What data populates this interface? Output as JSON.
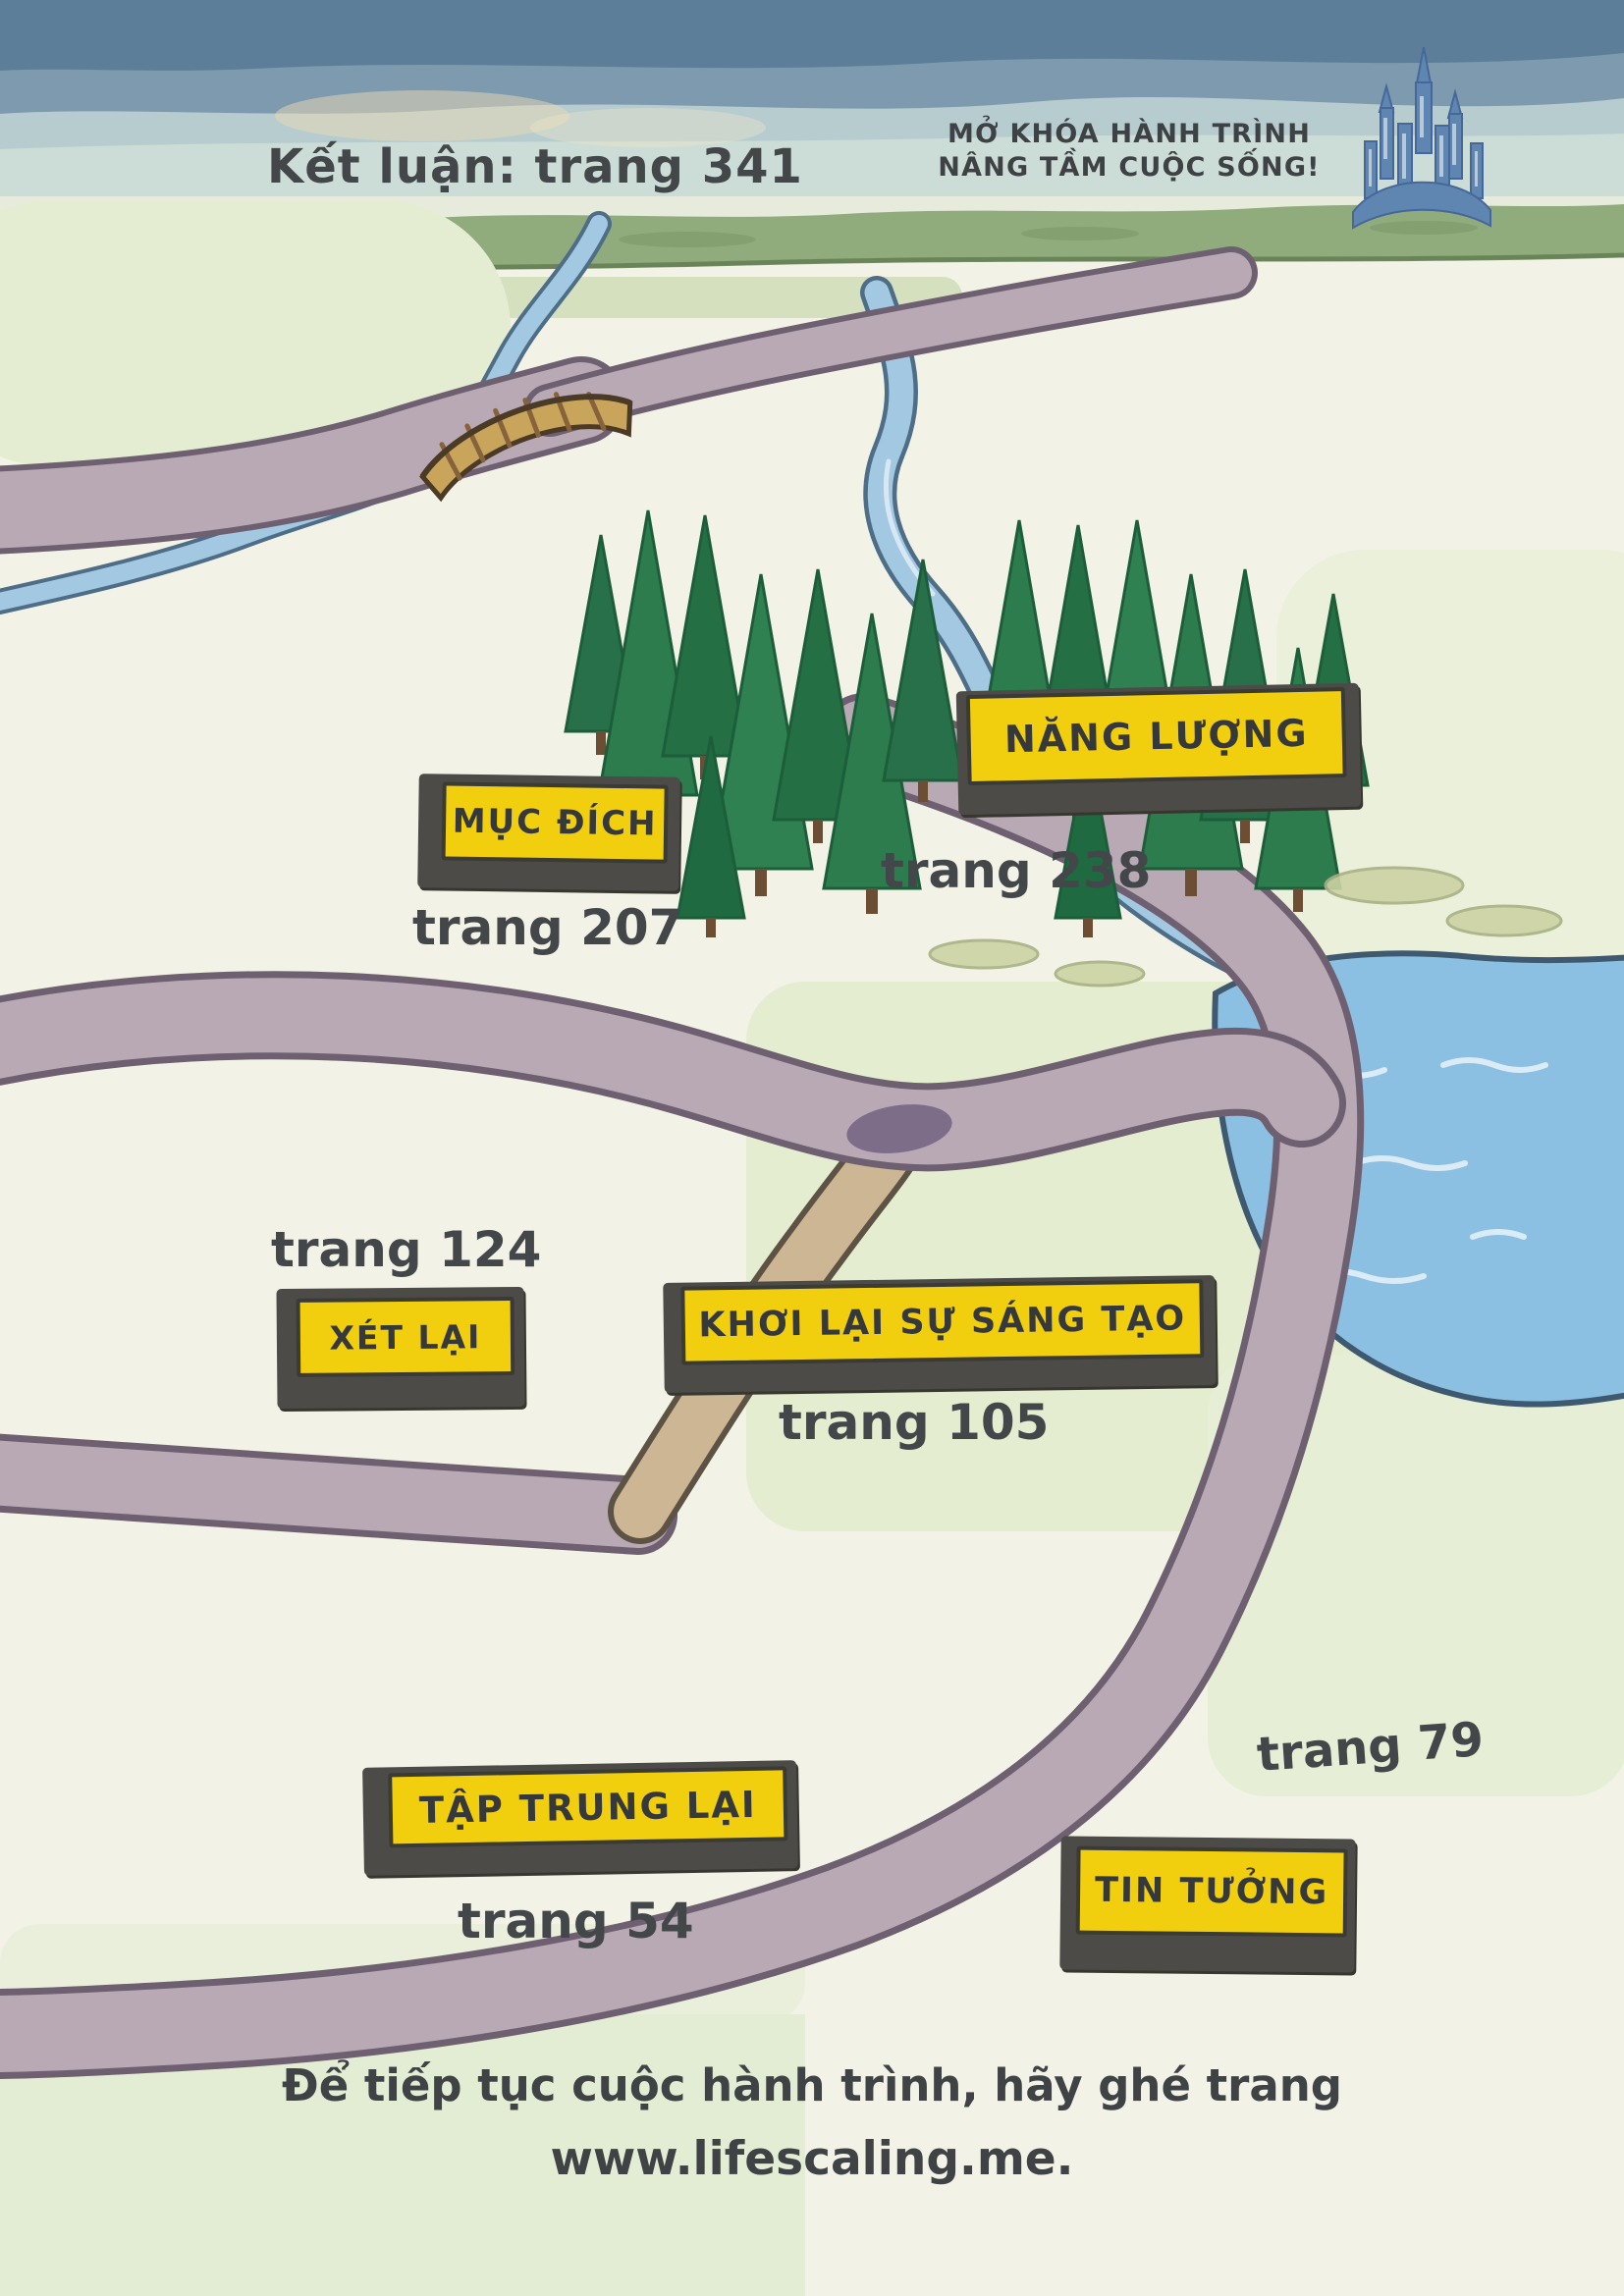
{
  "header": {
    "conclusion": "Kết luận: trang 341",
    "slogan_line1": "MỞ KHÓA HÀNH TRÌNH",
    "slogan_line2": "NÂNG TẦM CUỘC SỐNG!"
  },
  "stops": [
    {
      "label": "NĂNG LƯỢNG",
      "page": "trang 238"
    },
    {
      "label": "MỤC ĐÍCH",
      "page": "trang 207"
    },
    {
      "label": "XÉT LẠI",
      "page": "trang 124"
    },
    {
      "label": "KHƠI LẠI SỰ SÁNG TẠO",
      "page": "trang 105"
    },
    {
      "label": "TIN TƯỞNG",
      "page": "trang 79"
    },
    {
      "label": "TẬP TRUNG LẠI",
      "page": "trang 54"
    }
  ],
  "footer": {
    "line1": "Để tiếp tục cuộc hành trình, hãy ghé trang",
    "line2": "www.lifescaling.me."
  },
  "colors": {
    "sign_yellow": "#f2cf0e",
    "sign_border": "#3b3b36",
    "sign_shadow": "#4c4b47",
    "text_dark": "#43474a",
    "road": "#b8a9b4",
    "road_outline": "#6e6070",
    "path_tan": "#cdb694",
    "river": "#a3c8e1",
    "lake": "#8cc0e2",
    "tree_green": "#2c7c4e",
    "horizon_green": "#90ab7c",
    "castle_blue": "#5e86b1"
  },
  "icons": {
    "castle": "castle-icon",
    "bridge": "bridge-icon",
    "pond": "pond-marker"
  }
}
